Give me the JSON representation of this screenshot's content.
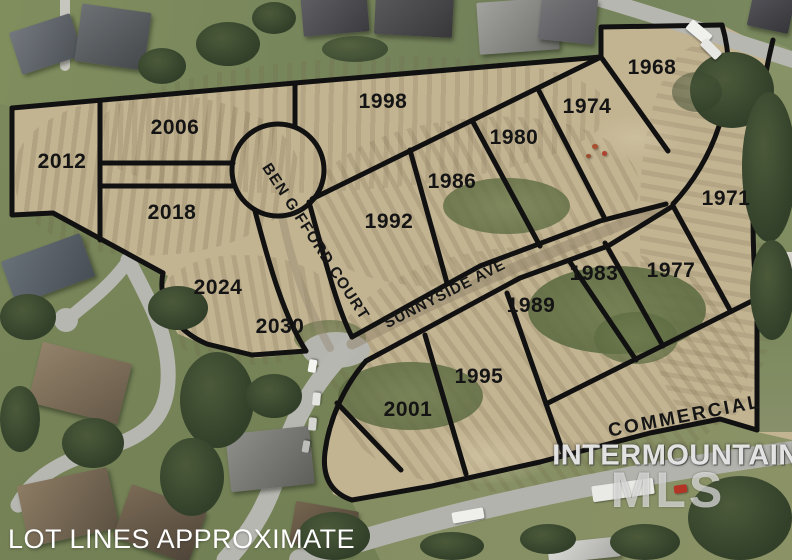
{
  "map": {
    "disclaimer": "LOT LINES APPROXIMATE",
    "watermark": {
      "brand": "INTERMOUNTAIN",
      "logo": "MLS"
    },
    "streets": [
      {
        "name": "BEN GIFFORD COURT"
      },
      {
        "name": "SUNNYSIDE AVE"
      }
    ],
    "zone": {
      "commercial_label": "COMMERCIAL"
    },
    "lots": [
      {
        "number": "1968"
      },
      {
        "number": "1971"
      },
      {
        "number": "1974"
      },
      {
        "number": "1977"
      },
      {
        "number": "1980"
      },
      {
        "number": "1983"
      },
      {
        "number": "1986"
      },
      {
        "number": "1989"
      },
      {
        "number": "1992"
      },
      {
        "number": "1995"
      },
      {
        "number": "1998"
      },
      {
        "number": "2001"
      },
      {
        "number": "2006"
      },
      {
        "number": "2012"
      },
      {
        "number": "2018"
      },
      {
        "number": "2024"
      },
      {
        "number": "2030"
      }
    ],
    "colors": {
      "lot_line": "#111111",
      "field_tan": "#c2b391",
      "label_text": "#141414",
      "watermark": "#ffffff"
    }
  }
}
